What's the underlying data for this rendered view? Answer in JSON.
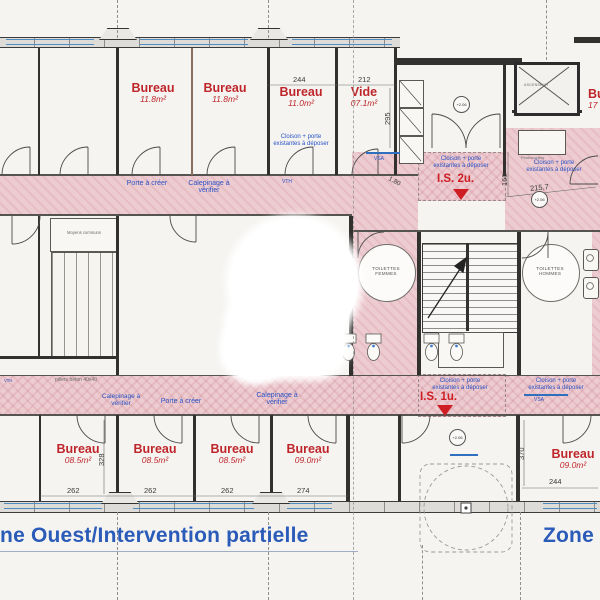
{
  "zones": {
    "west": "Zone Ouest/Intervention partielle",
    "east": "Zone Est"
  },
  "rooms": {
    "top": [
      {
        "label": "Bureau",
        "area": "11.8m²"
      },
      {
        "label": "Bureau",
        "area": "11.8m²"
      },
      {
        "label": "Bureau",
        "area": "11.0m²"
      },
      {
        "label": "Vide",
        "area": "07.1m²"
      },
      {
        "label": "Bureau",
        "area": "17"
      }
    ],
    "bottom": [
      {
        "label": "Bureau",
        "area": "08.5m²"
      },
      {
        "label": "Bureau",
        "area": "08.5m²"
      },
      {
        "label": "Bureau",
        "area": "08.5m²"
      },
      {
        "label": "Bureau",
        "area": "09.0m²"
      },
      {
        "label": "Bureau",
        "area": "09.0m²"
      }
    ],
    "toilets_women_line1": "TOILETTES",
    "toilets_women_line2": "FEMMES",
    "toilets_men_line1": "TOILETTES",
    "toilets_men_line2": "HOMMES",
    "moyens": "Moyens communs"
  },
  "annotations": {
    "cloison_line1": "Cloison + porte",
    "cloison_line2": "existantes à déposer",
    "porte_creer": "Porte à créer",
    "calepinage_line1": "Calepinage à",
    "calepinage_line2": "vérifier",
    "is2": "I.S. 2u.",
    "is1": "I.S. 1u.",
    "piliers": "piliers béton 40x40",
    "photocopieur": "Photocopieur",
    "ascenseur": "ASCENSEUR",
    "vsa": "VSA",
    "vth": "VTH",
    "level": "+2.06"
  },
  "dimensions": {
    "d244": "244",
    "d212": "212",
    "d295": "295",
    "d160": "160",
    "d215_7": "215,7",
    "d1_80": "1,80",
    "d328": "328",
    "d262": "262",
    "d274": "274",
    "d370": "370"
  },
  "colors": {
    "corridor_pink": "#edccd1",
    "annotation_blue": "#2a52c4",
    "room_red": "#bf262b",
    "zone_blue": "#2b5bb8",
    "wall": "#33312f",
    "window_blue": "#4f8cc0"
  }
}
